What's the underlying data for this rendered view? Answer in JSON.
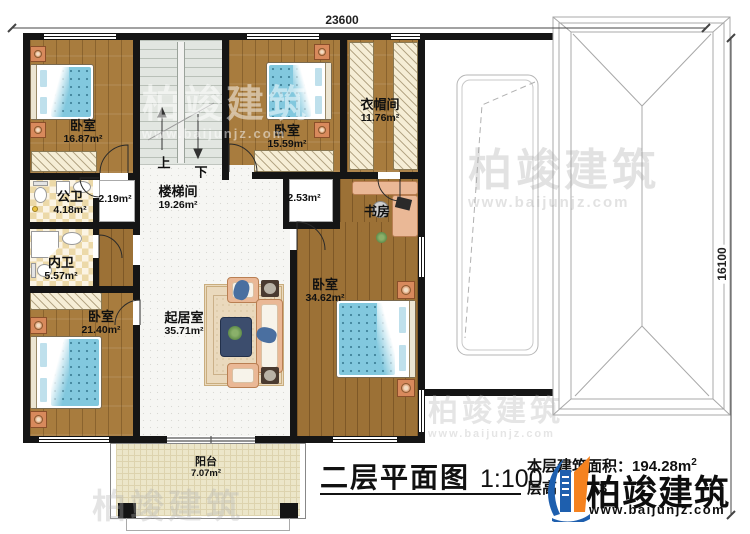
{
  "plan": {
    "title": "二层平面图",
    "scale": "1:100",
    "dim_top": "23600",
    "dim_right": "16100"
  },
  "rooms": {
    "bedroom_tl": {
      "label": "卧室",
      "area": "16.87m²"
    },
    "stairwell": {
      "label": "楼梯间",
      "area": "19.26m²"
    },
    "bedroom_tm": {
      "label": "卧室",
      "area": "15.59m²"
    },
    "cloakroom": {
      "label": "衣帽间",
      "area": "11.76m²"
    },
    "public_bath": {
      "label": "公卫",
      "area": "4.18m²"
    },
    "alcove_left": {
      "area": "2.19m²"
    },
    "alcove_right": {
      "area": "2.53m²"
    },
    "private_bath": {
      "label": "内卫",
      "area": "5.57m²"
    },
    "bedroom_bl": {
      "label": "卧室",
      "area": "21.40m²"
    },
    "living": {
      "label": "起居室",
      "area": "35.71m²"
    },
    "study": {
      "label": "书房"
    },
    "bedroom_r": {
      "label": "卧室",
      "area": "34.62m²"
    },
    "balcony": {
      "label": "阳台",
      "area": "7.07m²"
    }
  },
  "stairs": {
    "up": "上",
    "down": "下"
  },
  "stats": {
    "area_label": "本层建筑面积：",
    "area_value": "194.28m",
    "area_sup": "2",
    "height_label": "层高",
    "height_visible": "3"
  },
  "branding": {
    "name": "柏竣建筑",
    "url": "www.baijunjz.com"
  },
  "colors": {
    "wall": "#151515",
    "logo_blue": "#1e5fae",
    "logo_orange": "#f5821f",
    "bed_blue": "#82c8de"
  }
}
